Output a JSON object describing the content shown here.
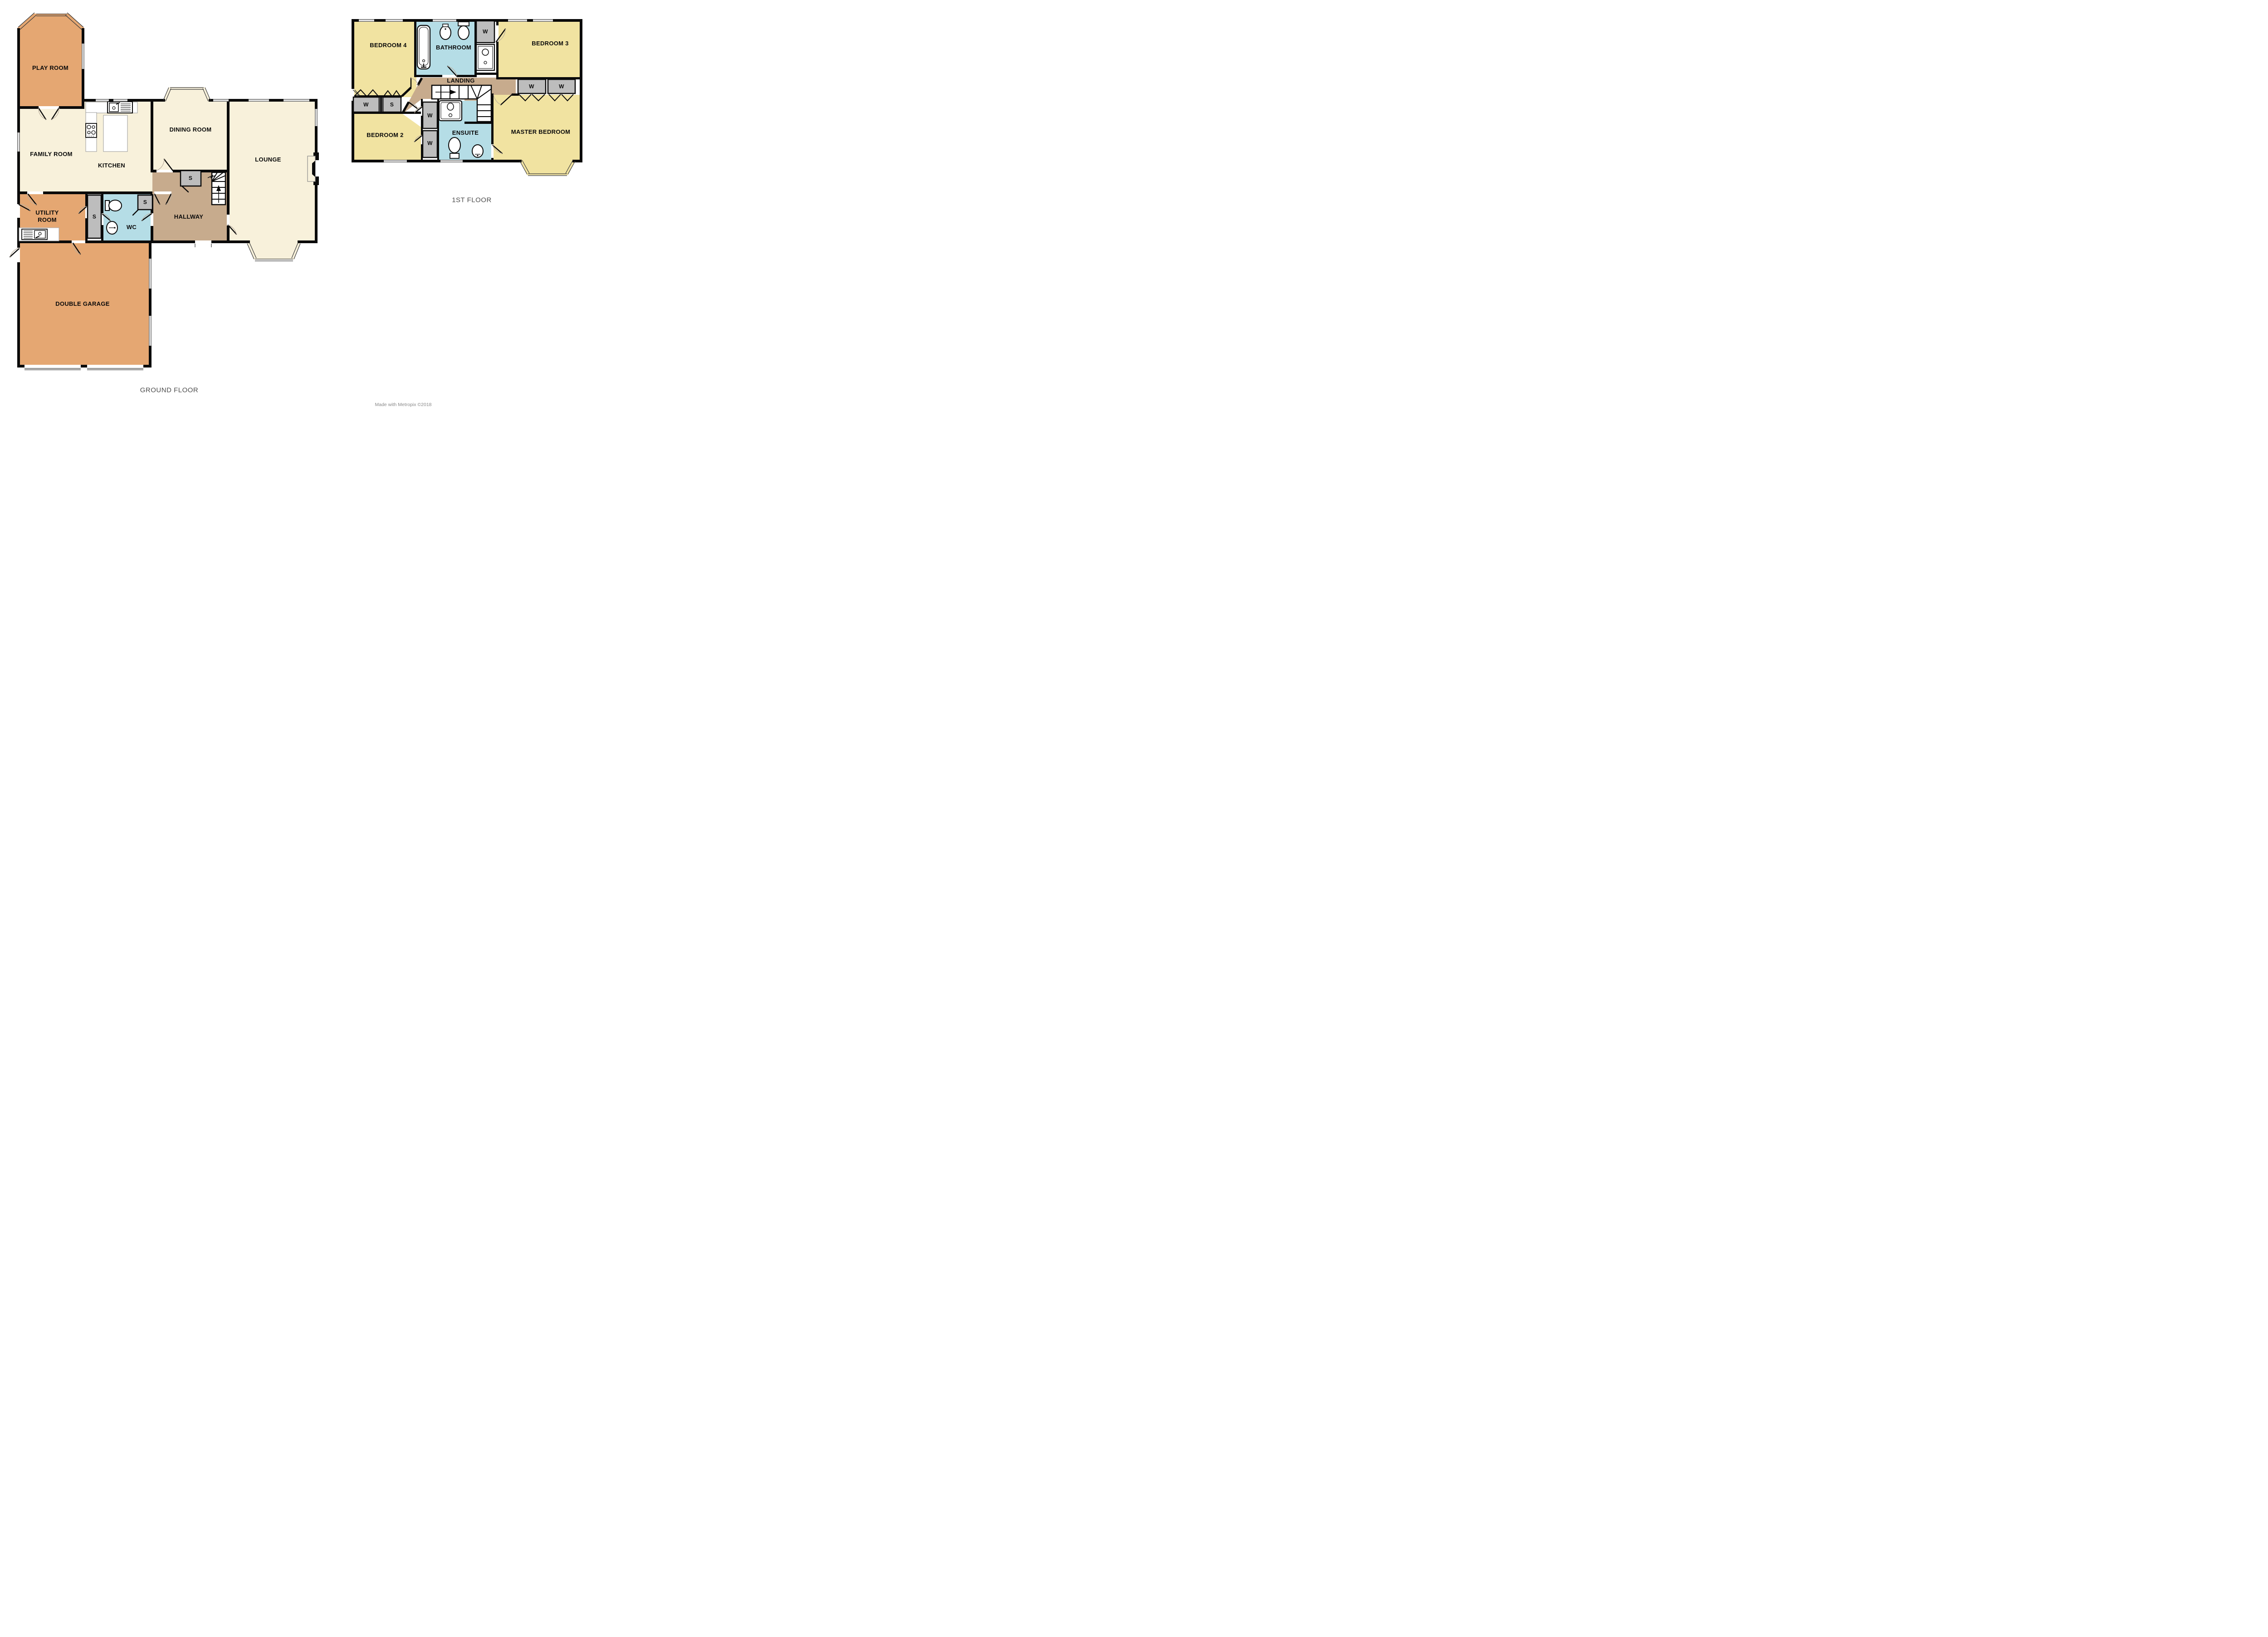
{
  "floors": {
    "ground": {
      "title": "GROUND FLOOR",
      "rooms": [
        {
          "label": "PLAY ROOM"
        },
        {
          "label": "FAMILY ROOM"
        },
        {
          "label": "KITCHEN"
        },
        {
          "label": "DINING ROOM"
        },
        {
          "label": "LOUNGE"
        },
        {
          "label": "UTILITY ROOM"
        },
        {
          "label": "WC"
        },
        {
          "label": "HALLWAY"
        },
        {
          "label": "DOUBLE GARAGE"
        }
      ],
      "cupboards": [
        {
          "label": "S"
        },
        {
          "label": "S"
        },
        {
          "label": "S"
        }
      ]
    },
    "first": {
      "title": "1ST FLOOR",
      "rooms": [
        {
          "label": "BEDROOM 4"
        },
        {
          "label": "BATHROOM"
        },
        {
          "label": "BEDROOM 3"
        },
        {
          "label": "LANDING"
        },
        {
          "label": "BEDROOM 2"
        },
        {
          "label": "ENSUITE"
        },
        {
          "label": "MASTER BEDROOM"
        }
      ],
      "cupboards": [
        {
          "label": "W"
        },
        {
          "label": "W"
        },
        {
          "label": "S"
        },
        {
          "label": "W"
        },
        {
          "label": "W"
        },
        {
          "label": "W"
        },
        {
          "label": "W"
        }
      ]
    }
  },
  "footer": {
    "credit": "Made with Metropix ©2018"
  },
  "colors": {
    "orange_room": "#E5A772",
    "cream_room": "#F8F1DB",
    "yellow_room": "#F1E3A1",
    "blue_room": "#B5DDE6",
    "tan_hall": "#C7AB8D",
    "cupboard_gray": "#BDBDBD",
    "wall": "#0A0A0A"
  }
}
